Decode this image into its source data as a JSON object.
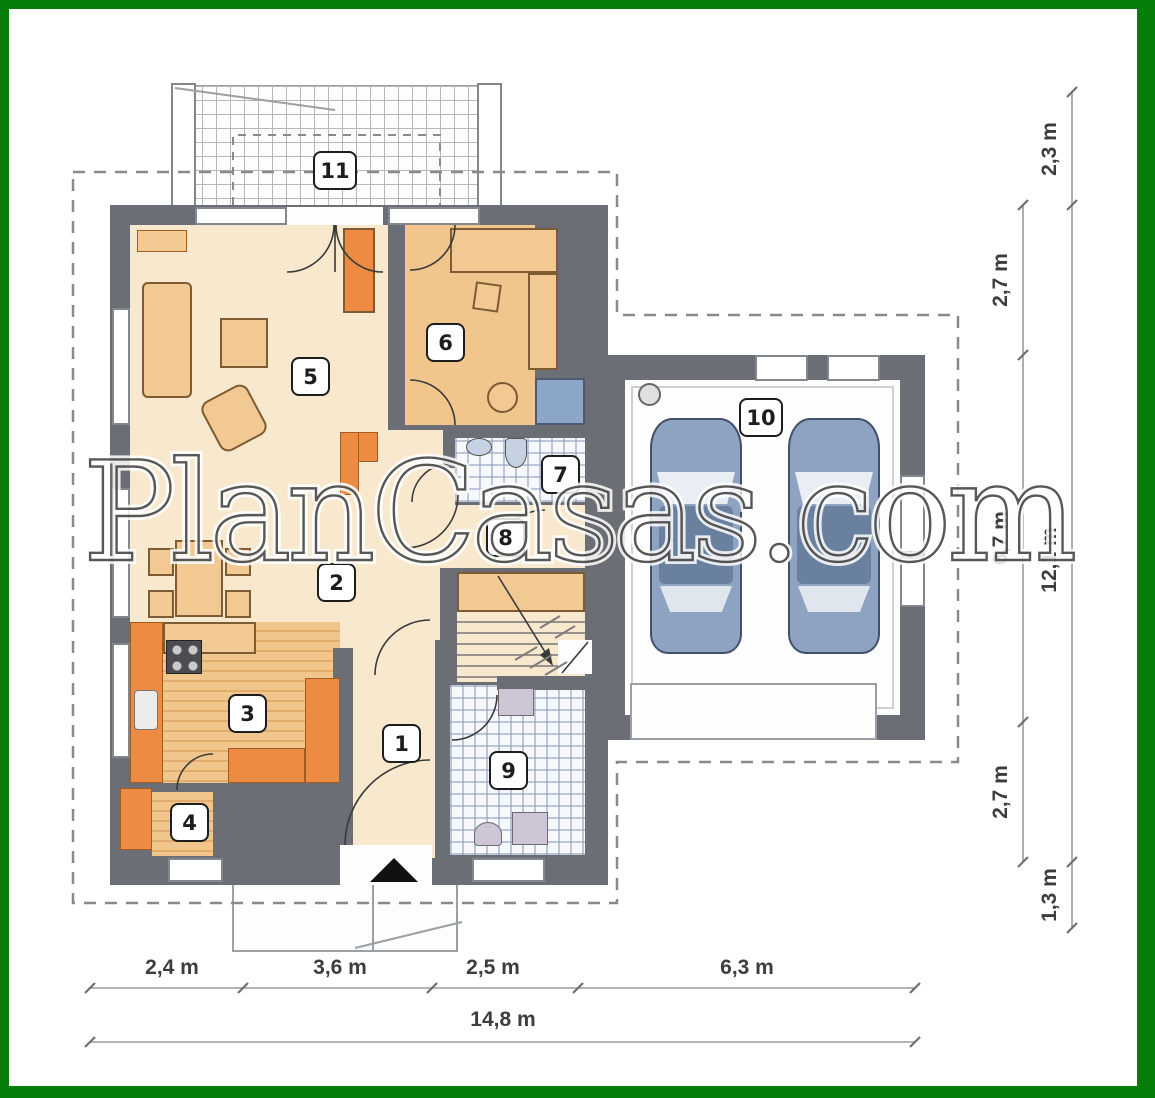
{
  "watermark": "PlanCasas.com",
  "plan": {
    "room_labels": [
      "1",
      "2",
      "3",
      "4",
      "5",
      "6",
      "7",
      "8",
      "9",
      "10",
      "11"
    ]
  },
  "dimensions": {
    "bottom_segments": [
      "2,4 m",
      "3,6 m",
      "2,5 m",
      "6,3 m"
    ],
    "bottom_total": "14,8 m",
    "right_inner_segments": [
      "2,7 m",
      "6,7 m",
      "2,7 m"
    ],
    "right_outer_segments": [
      "2,3 m",
      "12,1 m",
      "1,3 m"
    ]
  },
  "colors": {
    "frame_green": "#067d06",
    "wall_gray": "#6b6e74",
    "floor_cream": "#f8e8cd",
    "floor_tan": "#f1c68c",
    "furniture_orange": "#ec8b41",
    "tile_blue": "#8ba6c9",
    "car_blue": "#8ea2c2"
  }
}
